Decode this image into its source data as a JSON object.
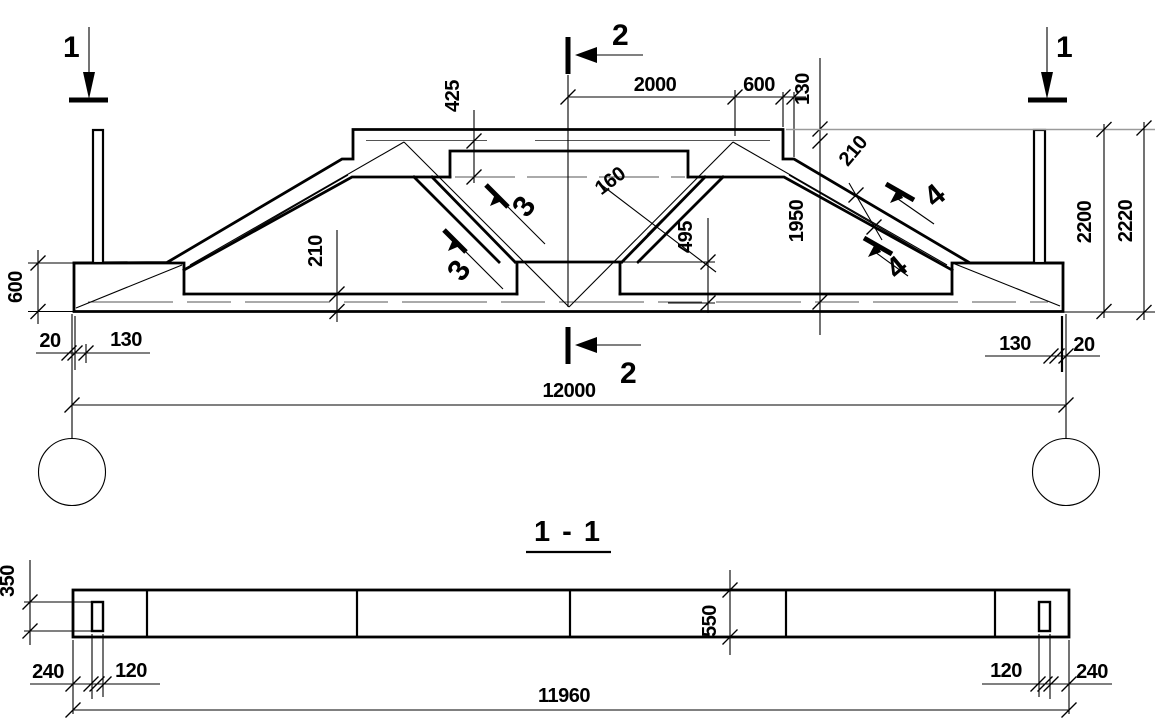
{
  "drawing": {
    "type": "structural truss girder drawing",
    "views": [
      "elevation",
      "section 1-1"
    ]
  },
  "elevation": {
    "markers": {
      "m1_left": "1",
      "m1_right": "1",
      "m2_top": "2",
      "m2_bottom": "2",
      "m3_upper": "3",
      "m3_lower": "3",
      "m4_upper": "4",
      "m4_lower": "4"
    },
    "dims": {
      "top_2000": "2000",
      "top_600": "600",
      "top_130": "130",
      "left_425": "425",
      "chord_210": "210",
      "flange_210": "210",
      "web_160": "160",
      "mid_495": "495",
      "right_1950": "1950",
      "height_2200": "2200",
      "height_2220": "2220",
      "end_600": "600",
      "bottom_left_20": "20",
      "bottom_left_130": "130",
      "bottom_right_130": "130",
      "bottom_right_20": "20",
      "span_12000": "12000"
    }
  },
  "section": {
    "title": "1 - 1",
    "dims": {
      "pocket_350": "350",
      "left_240": "240",
      "left_120": "120",
      "width_550": "550",
      "right_120": "120",
      "right_240": "240",
      "span_11960": "11960"
    }
  }
}
